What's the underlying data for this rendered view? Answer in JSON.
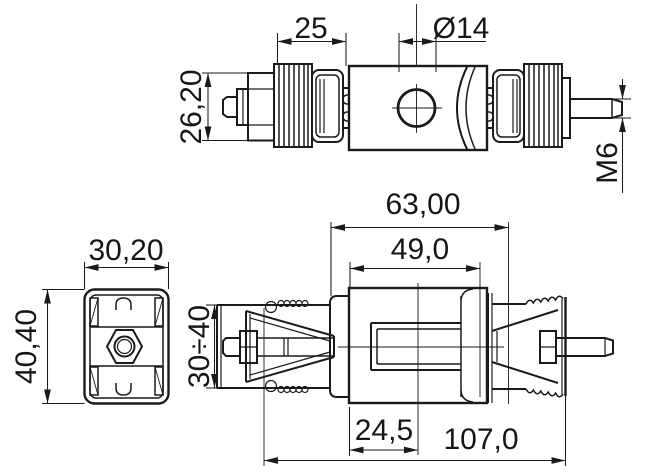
{
  "drawing": {
    "kind": "engineering-drawing",
    "background": "#ffffff",
    "line_color": "#1a1a1a"
  },
  "views": {
    "side": {
      "dims": {
        "length": "25",
        "hole_diameter": "Ø14",
        "height": "26,20",
        "thread": "M6"
      }
    },
    "end": {
      "dims": {
        "width": "30,20",
        "height": "40,40"
      }
    },
    "section": {
      "dims": {
        "body_length": "63,00",
        "inner_length": "49,0",
        "height_range": "30÷40",
        "slot_offset": "24,5",
        "overall_length": "107,0"
      }
    }
  }
}
